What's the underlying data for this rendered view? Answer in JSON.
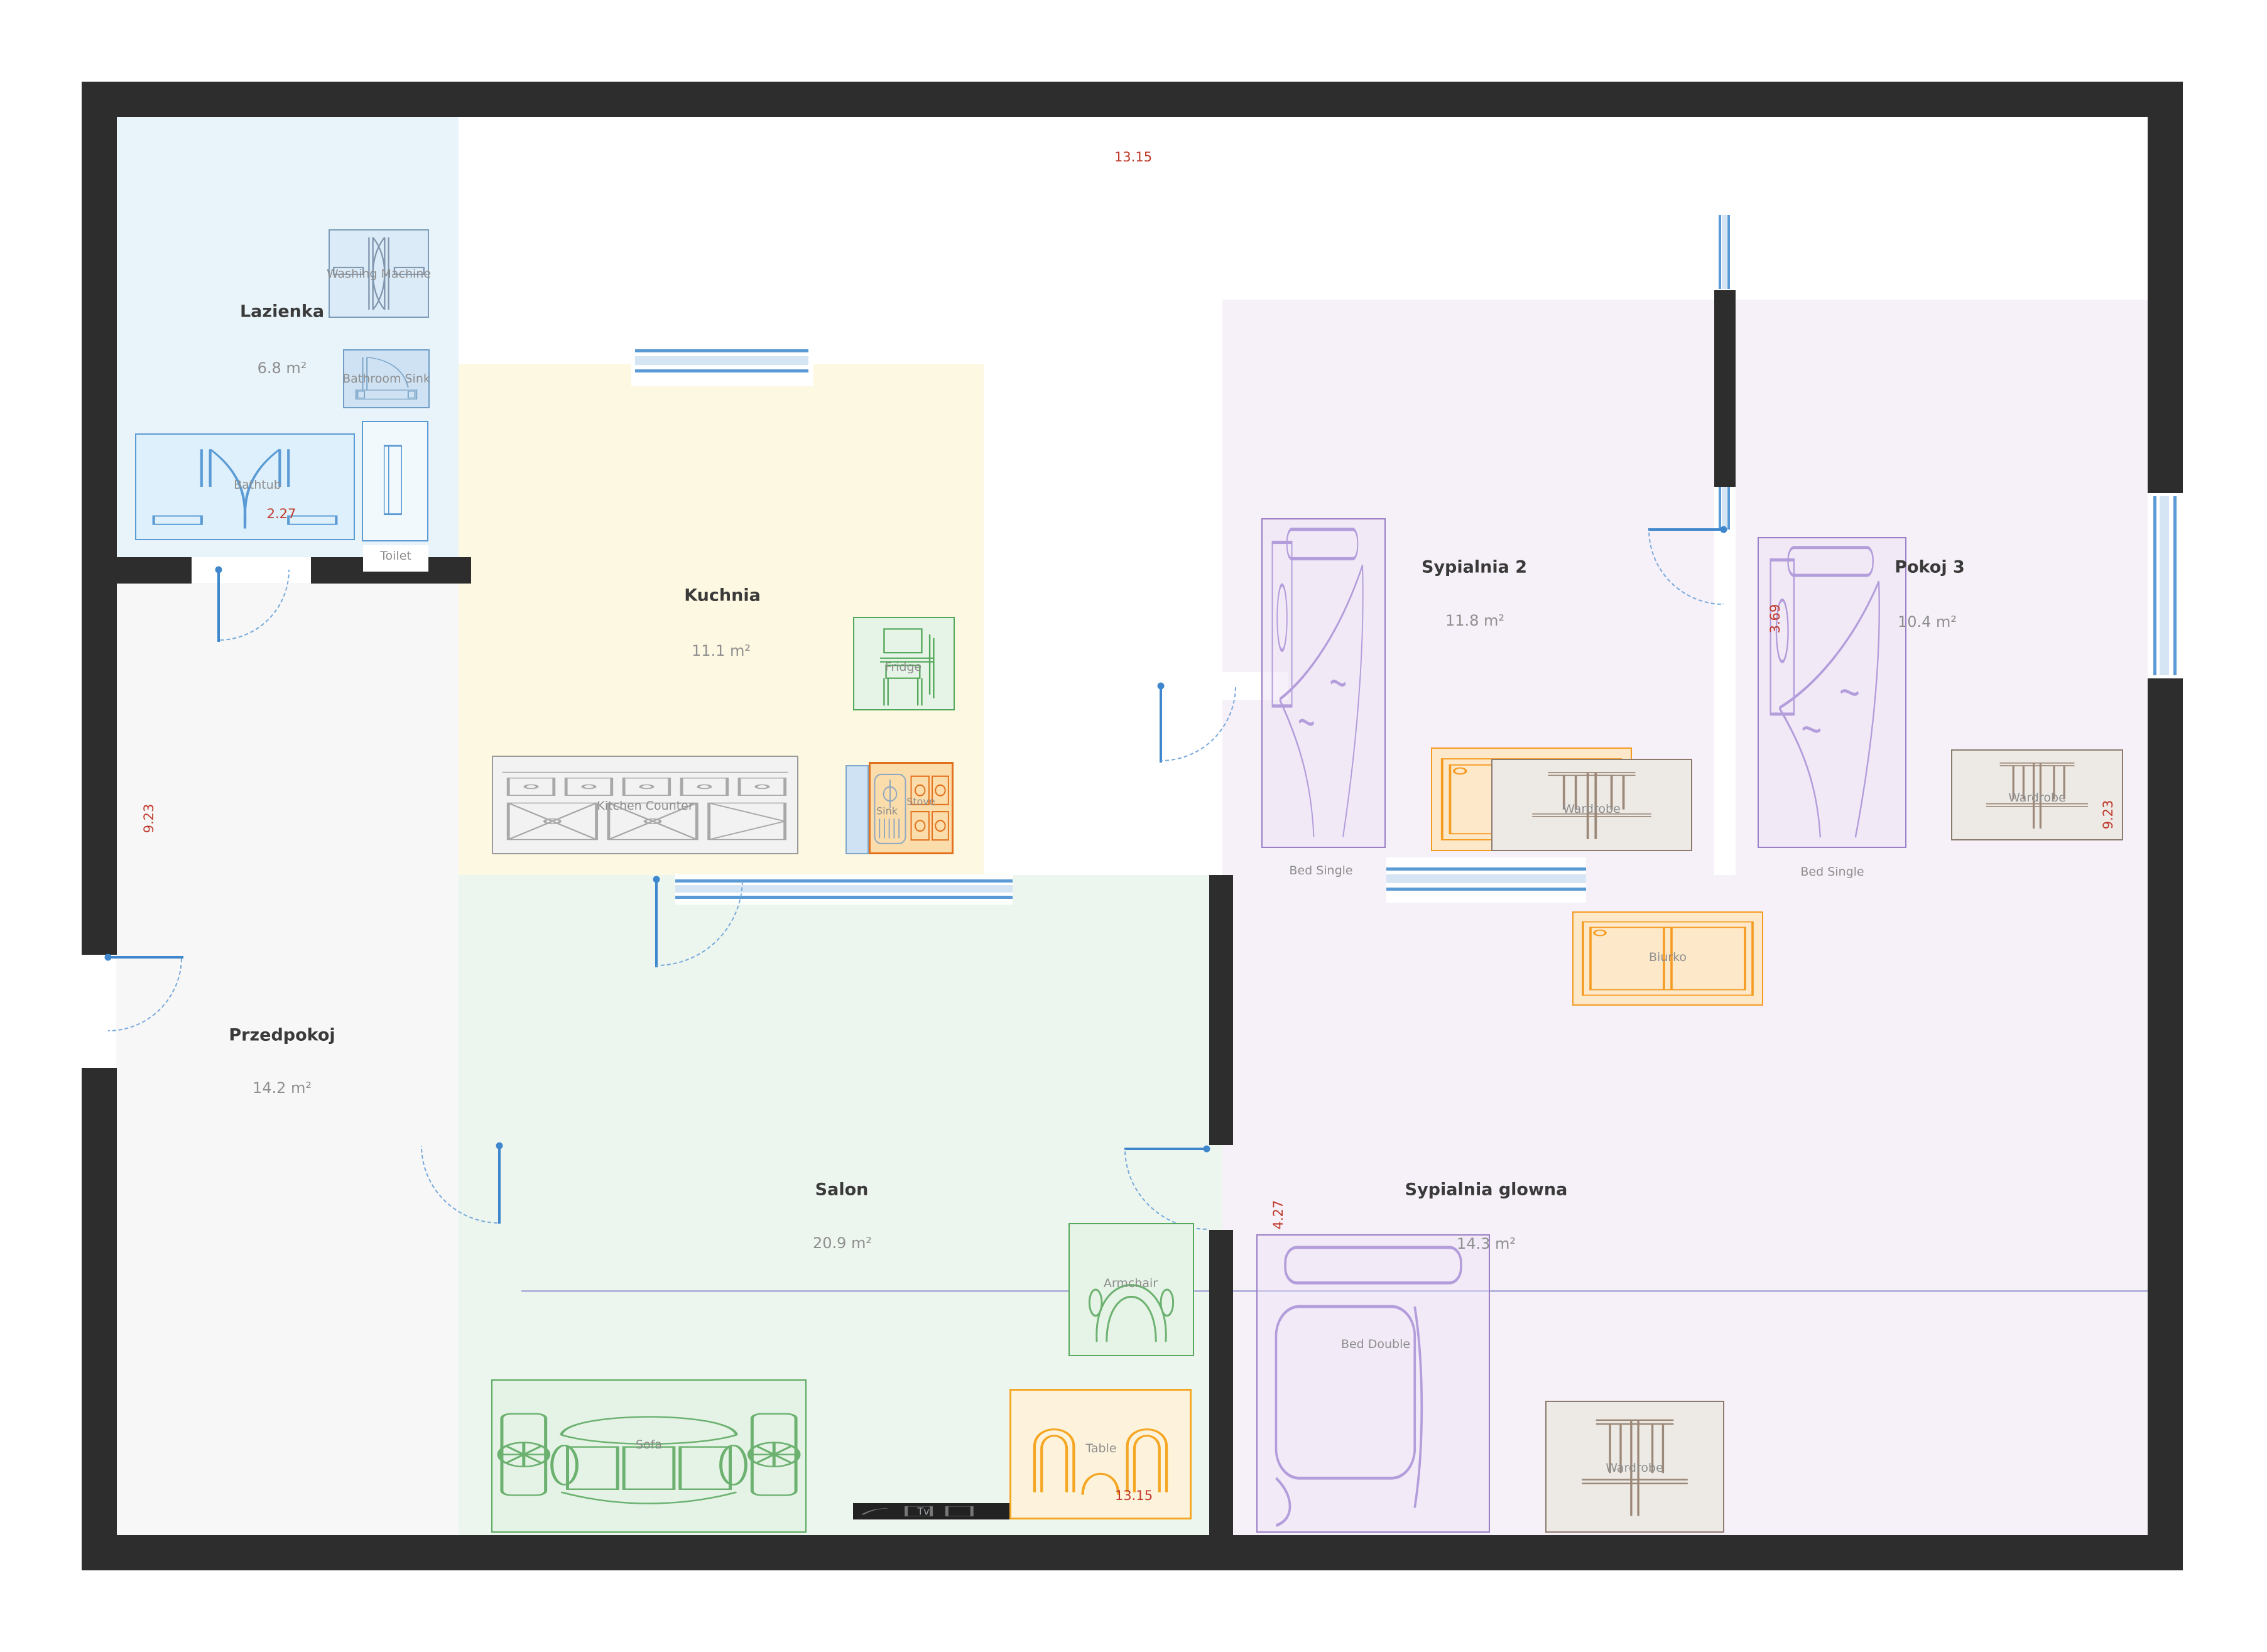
{
  "rooms": [
    {
      "id": "lazienka",
      "name": "Lazienka",
      "area": "6.8 m²"
    },
    {
      "id": "kuchnia",
      "name": "Kuchnia",
      "area": "11.1 m²"
    },
    {
      "id": "przedpokoj",
      "name": "Przedpokoj",
      "area": "14.2 m²"
    },
    {
      "id": "salon",
      "name": "Salon",
      "area": "20.9 m²"
    },
    {
      "id": "sypialnia2",
      "name": "Sypialnia 2",
      "area": "11.8 m²"
    },
    {
      "id": "pokoj3",
      "name": "Pokoj 3",
      "area": "10.4 m²"
    },
    {
      "id": "sypialnia_glowna",
      "name": "Sypialnia glowna",
      "area": "14.3 m²"
    }
  ],
  "furniture": {
    "washing_machine": "Washing Machine",
    "bathroom_sink": "Bathroom Sink",
    "bathtub": "Bathtub",
    "toilet": "Toilet",
    "fridge": "Fridge",
    "kitchen_counter": "Kitchen Counter",
    "sink": "Sink",
    "stove": "Stove",
    "sofa": "Sofa",
    "armchair": "Armchair",
    "table": "Table",
    "tv": "Tv",
    "bed_single": "Bed Single",
    "desk": "Desk",
    "wardrobe": "Wardrobe",
    "biurko": "Biurko",
    "bed_double": "Bed Double"
  },
  "dimensions": {
    "top": "13.15",
    "bottom": "13.15",
    "left": "9.23",
    "bathroom": "2.27",
    "pokoj3_height": "3.69",
    "pokoj3_right": "9.23",
    "sypialnia_glowna_height": "4.27"
  },
  "colors": {
    "wall": "#2d2d2d",
    "dimension_red": "#c0392b",
    "door_window_blue": "#5b9bd5",
    "bathroom_fill": "#e9f3fa",
    "kitchen_fill": "#fdf8e2",
    "hall_fill": "#f7f7f7",
    "living_fill": "#edf6ee",
    "bedroom_fill": "#f6f0f8",
    "green_furniture": "#58a85c",
    "orange_furniture": "#f59b22",
    "purple_furniture": "#9b7fc7",
    "wardrobe_brown": "#8d7b6d"
  }
}
